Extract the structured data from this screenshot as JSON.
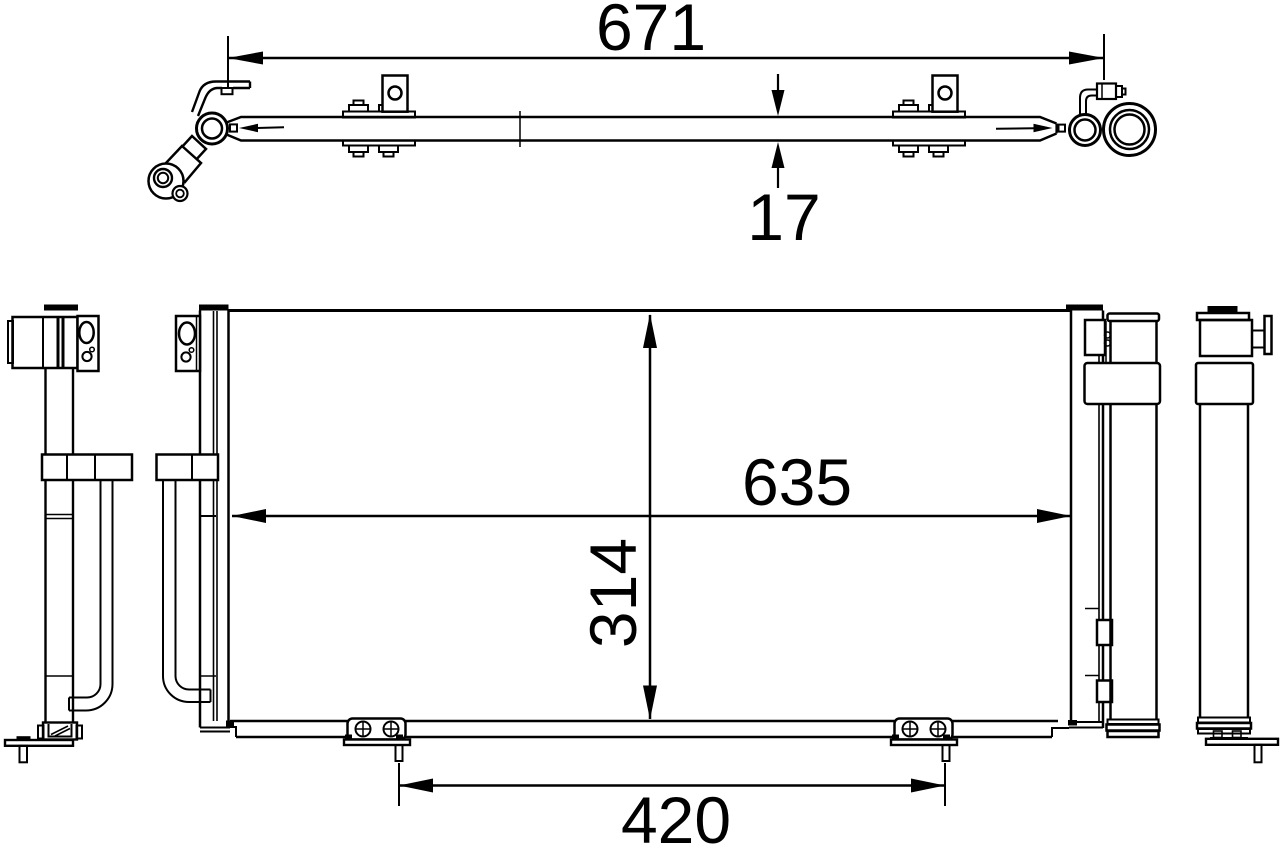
{
  "colors": {
    "background": "#ffffff",
    "line": "#000000"
  },
  "dimensions": {
    "overall_width": "671",
    "profile_thickness": "17",
    "core_width": "635",
    "core_height": "314",
    "mount_spacing": "420"
  }
}
